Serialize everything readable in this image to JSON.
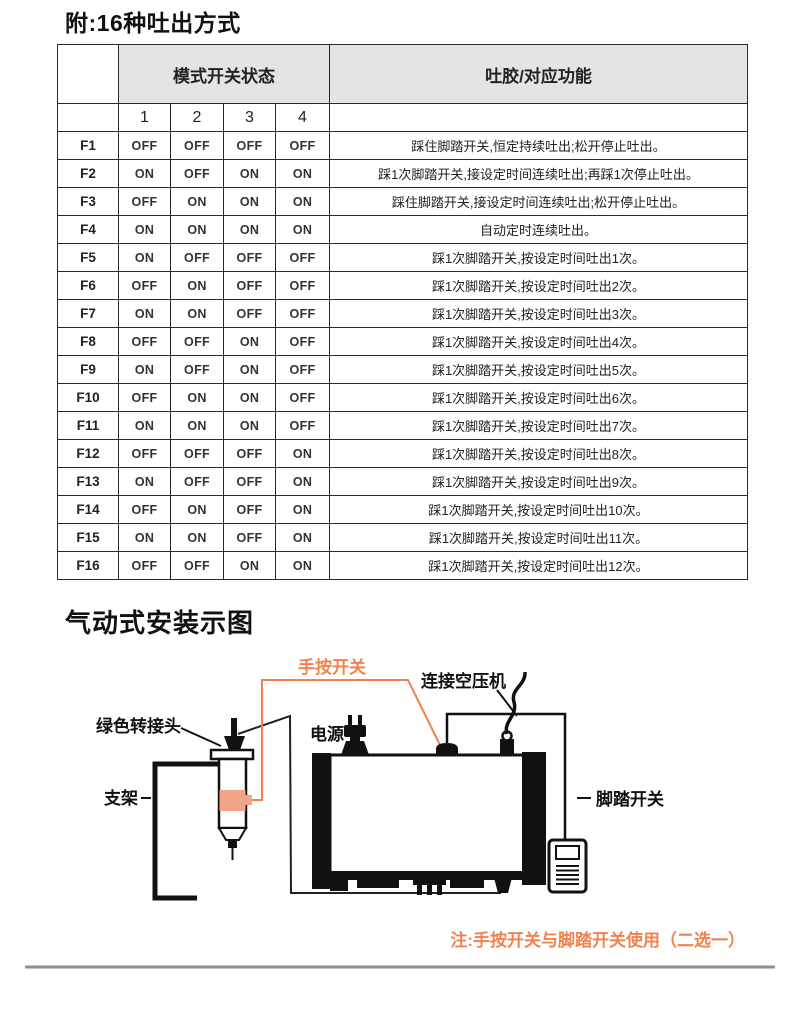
{
  "titles": {
    "main": "附:16种吐出方式",
    "diagram": "气动式安装示图"
  },
  "table": {
    "header": {
      "mode_switch": "模式开关状态",
      "function": "吐胶/对应功能",
      "cols": [
        "1",
        "2",
        "3",
        "4"
      ]
    },
    "rows": [
      {
        "mode": "F1",
        "s1": "OFF",
        "s2": "OFF",
        "s3": "OFF",
        "s4": "OFF",
        "desc": "踩住脚踏开关,恒定持续吐出;松开停止吐出。"
      },
      {
        "mode": "F2",
        "s1": "ON",
        "s2": "OFF",
        "s3": "ON",
        "s4": "ON",
        "desc": "踩1次脚踏开关,接设定时间连续吐出;再踩1次停止吐出。"
      },
      {
        "mode": "F3",
        "s1": "OFF",
        "s2": "ON",
        "s3": "ON",
        "s4": "ON",
        "desc": "踩住脚踏开关,接设定时间连续吐出;松开停止吐出。"
      },
      {
        "mode": "F4",
        "s1": "ON",
        "s2": "ON",
        "s3": "ON",
        "s4": "ON",
        "desc": "自动定时连续吐出。"
      },
      {
        "mode": "F5",
        "s1": "ON",
        "s2": "OFF",
        "s3": "OFF",
        "s4": "OFF",
        "desc": "踩1次脚踏开关,按设定时间吐出1次。"
      },
      {
        "mode": "F6",
        "s1": "OFF",
        "s2": "ON",
        "s3": "OFF",
        "s4": "OFF",
        "desc": "踩1次脚踏开关,按设定时间吐出2次。"
      },
      {
        "mode": "F7",
        "s1": "ON",
        "s2": "ON",
        "s3": "OFF",
        "s4": "OFF",
        "desc": "踩1次脚踏开关,按设定时间吐出3次。"
      },
      {
        "mode": "F8",
        "s1": "OFF",
        "s2": "OFF",
        "s3": "ON",
        "s4": "OFF",
        "desc": "踩1次脚踏开关,按设定时间吐出4次。"
      },
      {
        "mode": "F9",
        "s1": "ON",
        "s2": "OFF",
        "s3": "ON",
        "s4": "OFF",
        "desc": "踩1次脚踏开关,按设定时间吐出5次。"
      },
      {
        "mode": "F10",
        "s1": "OFF",
        "s2": "ON",
        "s3": "ON",
        "s4": "OFF",
        "desc": "踩1次脚踏开关,按设定时间吐出6次。"
      },
      {
        "mode": "F11",
        "s1": "ON",
        "s2": "ON",
        "s3": "ON",
        "s4": "OFF",
        "desc": "踩1次脚踏开关,按设定时间吐出7次。"
      },
      {
        "mode": "F12",
        "s1": "OFF",
        "s2": "OFF",
        "s3": "OFF",
        "s4": "ON",
        "desc": "踩1次脚踏开关,按设定时间吐出8次。"
      },
      {
        "mode": "F13",
        "s1": "ON",
        "s2": "OFF",
        "s3": "OFF",
        "s4": "ON",
        "desc": "踩1次脚踏开关,按设定时间吐出9次。"
      },
      {
        "mode": "F14",
        "s1": "OFF",
        "s2": "ON",
        "s3": "OFF",
        "s4": "ON",
        "desc": "踩1次脚踏开关,按设定时间吐出10次。"
      },
      {
        "mode": "F15",
        "s1": "ON",
        "s2": "ON",
        "s3": "OFF",
        "s4": "ON",
        "desc": "踩1次脚踏开关,按设定时间吐出11次。"
      },
      {
        "mode": "F16",
        "s1": "OFF",
        "s2": "OFF",
        "s3": "ON",
        "s4": "ON",
        "desc": "踩1次脚踏开关,按设定时间吐出12次。"
      }
    ]
  },
  "diagram": {
    "labels": {
      "hand_switch": "手按开关",
      "compressor": "连接空压机",
      "green_adapter": "绿色转接头",
      "power": "电源",
      "stand": "支架",
      "foot_switch": "脚踏开关"
    },
    "note": "注:手按开关与脚踏开关使用（二选一）"
  },
  "colors": {
    "accent_orange": "#F0824E",
    "highlight_block": "#F2A487",
    "header_gray": "#E4E4E4",
    "table_border": "#2B2B2B"
  }
}
